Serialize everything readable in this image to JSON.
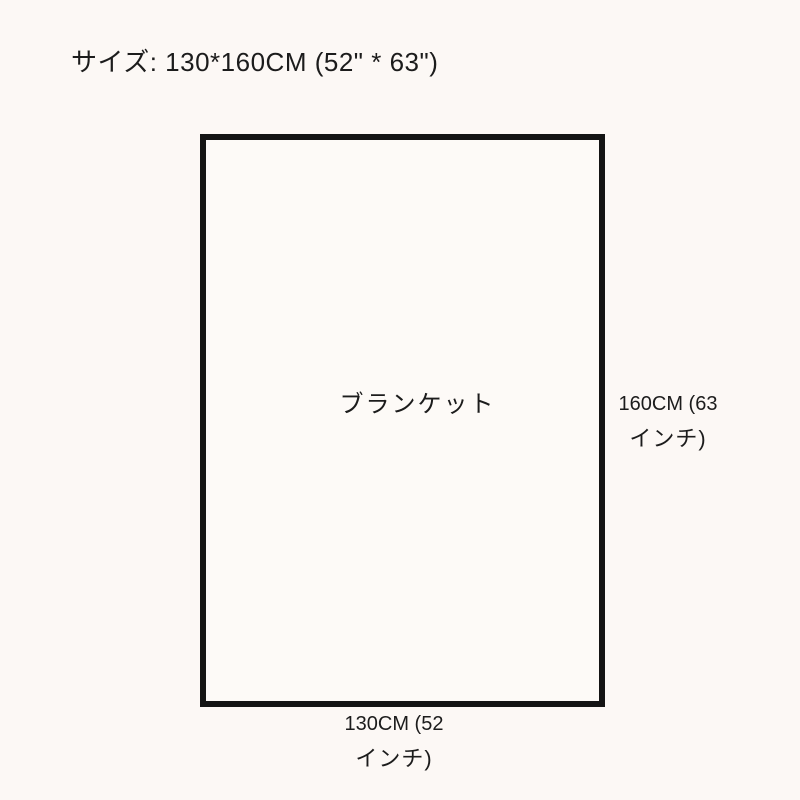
{
  "page": {
    "title": "サイズ: 130*160CM (52\" * 63\")"
  },
  "diagram": {
    "item_label": "ブランケット",
    "height_label_line1": "160CM (63",
    "height_label_line2": "インチ)",
    "width_label_line1": "130CM (52",
    "width_label_line2": "インチ)",
    "colors": {
      "background": "#fcf8f5",
      "rect_border": "#141414",
      "text": "#1c1c1c"
    }
  }
}
